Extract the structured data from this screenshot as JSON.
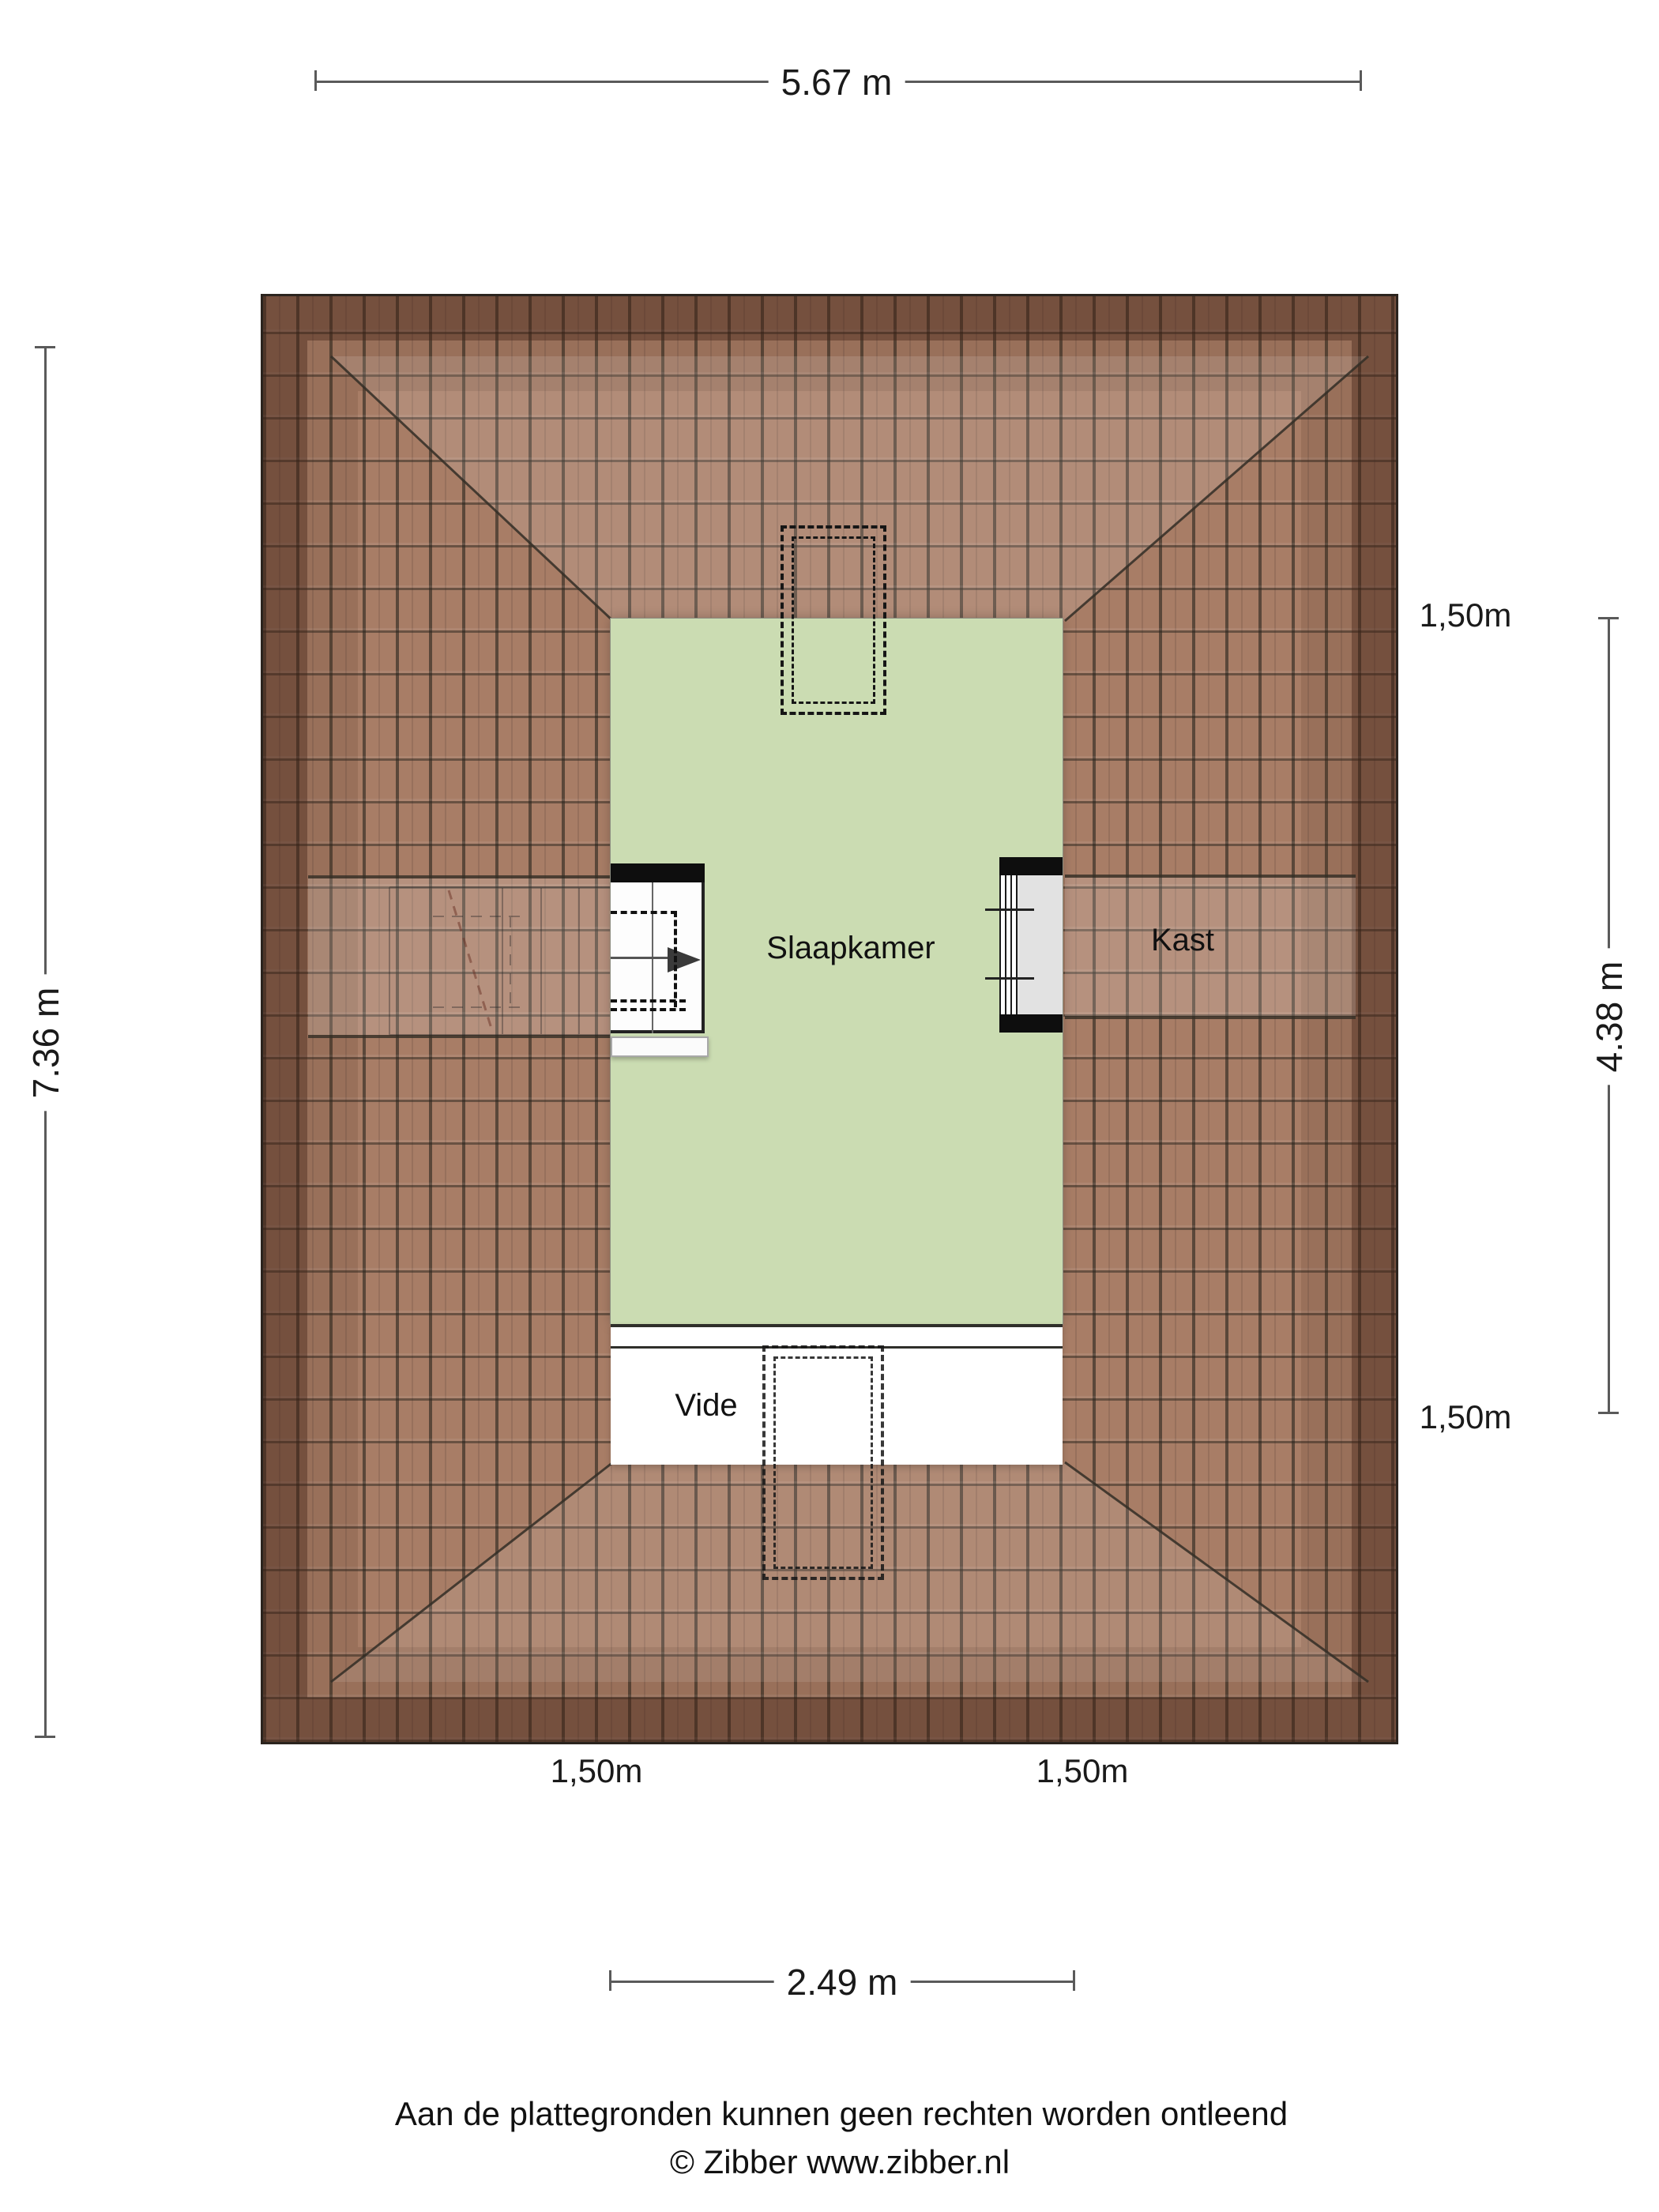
{
  "plan": {
    "rooms": [
      {
        "label": "Slaapkamer"
      },
      {
        "label": "Kast"
      },
      {
        "label": "Vide"
      }
    ],
    "dims": {
      "top": "5.67 m",
      "left": "7.36 m",
      "right": "4.38 m",
      "bottom": "2.49 m"
    },
    "offsets": {
      "right_top": "1,50m",
      "right_bottom": "1,50m",
      "bottom_left": "1,50m",
      "bottom_right": "1,50m"
    },
    "colors": {
      "room_green": "#cbdcb2",
      "tile_base": "#a87d66",
      "tile_joint": "#3c362c",
      "eave_shade": "#46261a",
      "dim_line": "#5a5a5a",
      "text": "#1a1a1a"
    }
  },
  "footer": {
    "disclaimer": "Aan de plattegronden kunnen geen rechten worden ontleend",
    "credit": "© Zibber www.zibber.nl"
  }
}
